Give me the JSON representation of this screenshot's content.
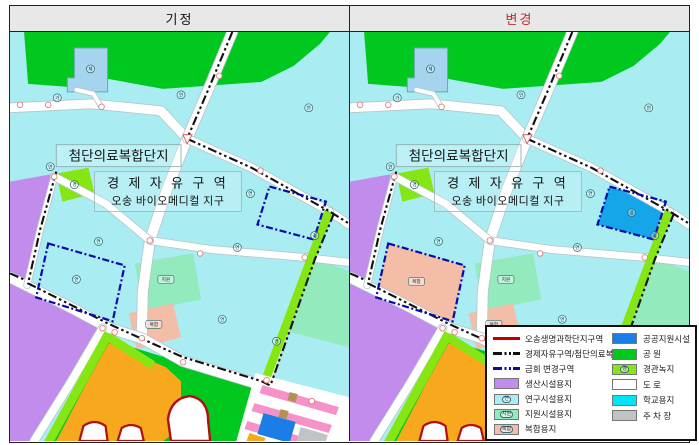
{
  "header": {
    "left_title": "기정",
    "right_title": "변경",
    "left_title_color": "#111111",
    "right_title_color": "#c03030"
  },
  "map_labels": {
    "complex_box": "첨단의료복합단지",
    "zone_line1": "경 제 자 유 구 역",
    "zone_line2": "오송 바이오메디컬 지구",
    "parcel_research": "연",
    "parcel_support": "지원",
    "parcel_mixed": "복합",
    "parcel_public": "공",
    "parcel_landscape": "경",
    "parcel_sports": "체",
    "parcel_access": "가"
  },
  "colors": {
    "research": "#a9ecf2",
    "park": "#00c81e",
    "production": "#c18cec",
    "support": "#93eabc",
    "mixed": "#f3bda7",
    "public": "#1a7ee6",
    "public_changed": "#14a6e8",
    "school": "#00e4f8",
    "landscape": "#86e614",
    "parking": "#c0c4c6",
    "road": "#ffffff",
    "pink_row": "#f592c8",
    "tan": "#ad9352",
    "orange": "#f7a81d",
    "lightblue": "#a6d3ee",
    "boundary_red": "#b01010",
    "boundary_black": "#111111",
    "boundary_navy": "#0a0aa6"
  },
  "legend": {
    "left": [
      {
        "type": "line",
        "style": "red",
        "label": "오송생명과학단지구역"
      },
      {
        "type": "line",
        "style": "dashk",
        "label": "경제자유구역/첨단의료복합단지"
      },
      {
        "type": "line",
        "style": "dashn",
        "label": "금회 변경구역"
      },
      {
        "type": "swatch",
        "color_key": "production",
        "label": "생산시설용지"
      },
      {
        "type": "swatch",
        "color_key": "research",
        "label": "연구시설용지",
        "mark": "연"
      },
      {
        "type": "swatch",
        "color_key": "support",
        "label": "지원시설용지",
        "mark": "지원"
      },
      {
        "type": "swatch",
        "color_key": "mixed",
        "label": "복합용지",
        "mark": "복합"
      }
    ],
    "right": [
      {
        "type": "swatch",
        "color_key": "public",
        "label": "공공지원시설"
      },
      {
        "type": "swatch",
        "color_key": "park",
        "label": "공 원"
      },
      {
        "type": "swatch",
        "color_key": "landscape",
        "label": "경관녹지",
        "mark": "경"
      },
      {
        "type": "swatch",
        "color_key": "road",
        "label": "도 로"
      },
      {
        "type": "swatch",
        "color_key": "school",
        "label": "학교용지"
      },
      {
        "type": "swatch",
        "color_key": "parking",
        "label": "주 차 장"
      }
    ]
  }
}
